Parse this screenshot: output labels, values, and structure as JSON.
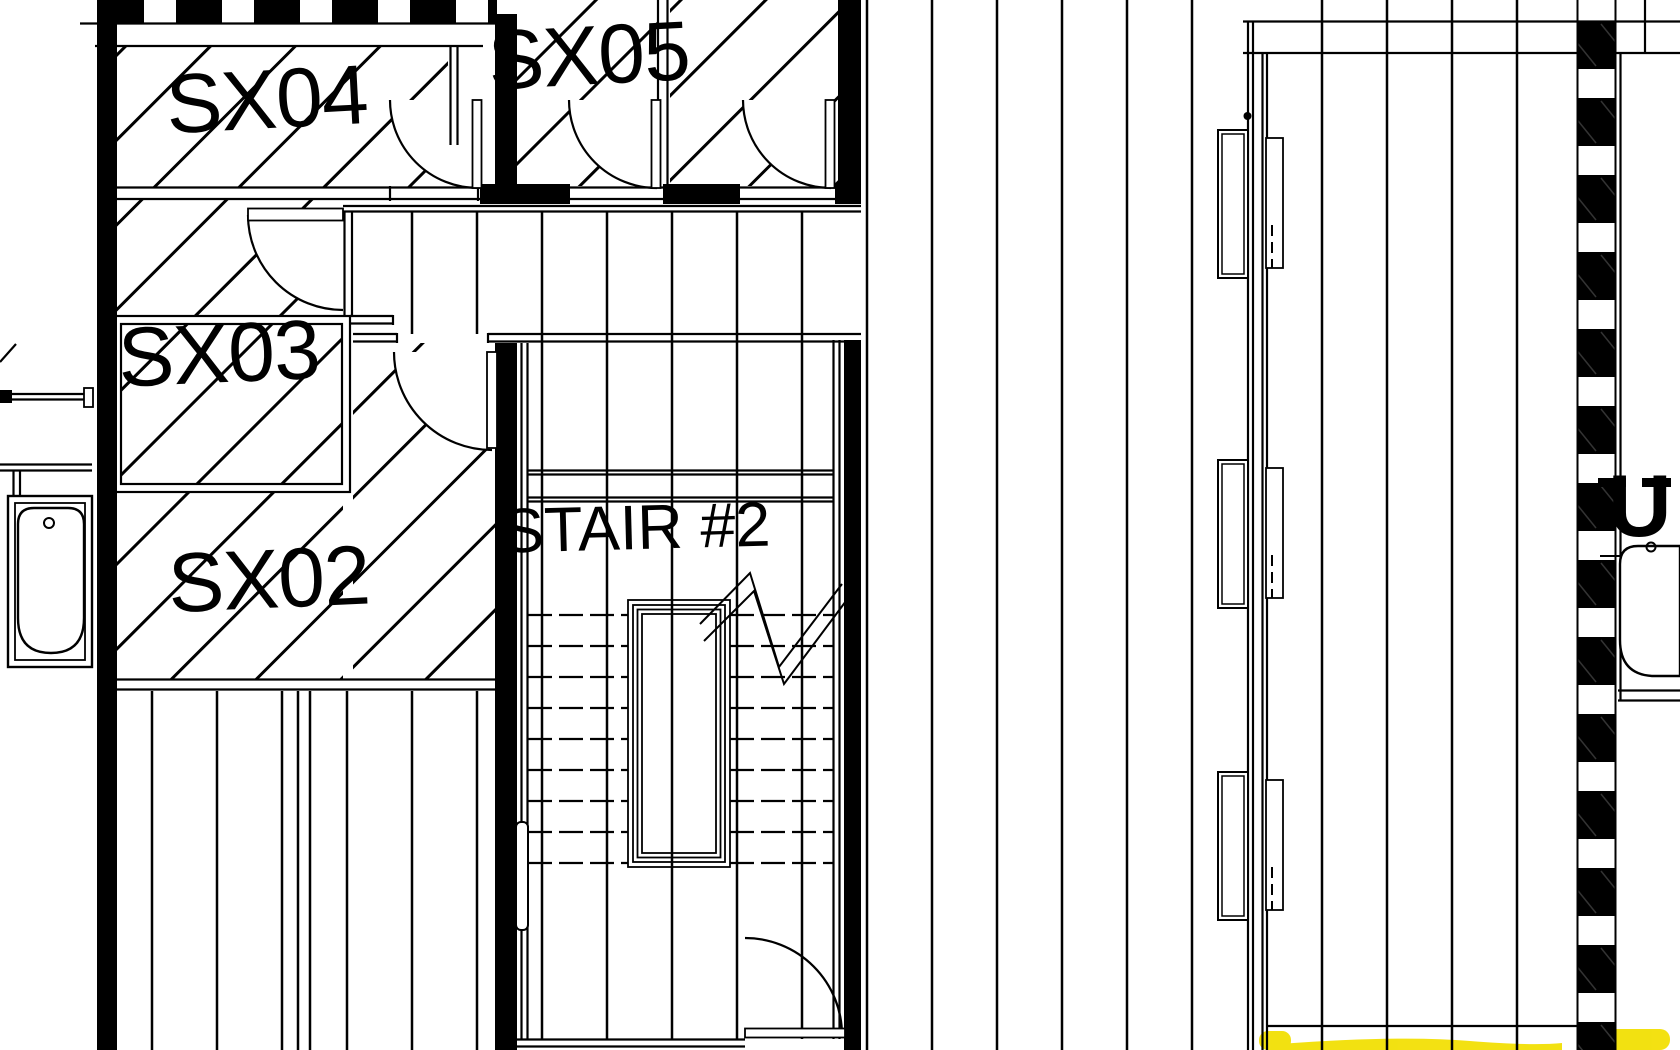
{
  "plan": {
    "type": "architectural-floor-plan",
    "rooms": [
      {
        "id": "sx04",
        "label": "SX04"
      },
      {
        "id": "sx05",
        "label": "SX05"
      },
      {
        "id": "sx03",
        "label": "SX03"
      },
      {
        "id": "sx02",
        "label": "SX02"
      }
    ],
    "stair": {
      "label": "STAIR #2"
    },
    "edge_text": {
      "label": "U"
    },
    "colors": {
      "ink": "#000000",
      "paper": "#ffffff",
      "highlight": "#f2df00"
    },
    "fixtures": {
      "left_fixture": "bathtub",
      "right_fixture": "bathtub",
      "window_count": 3,
      "stairs": 1
    }
  }
}
